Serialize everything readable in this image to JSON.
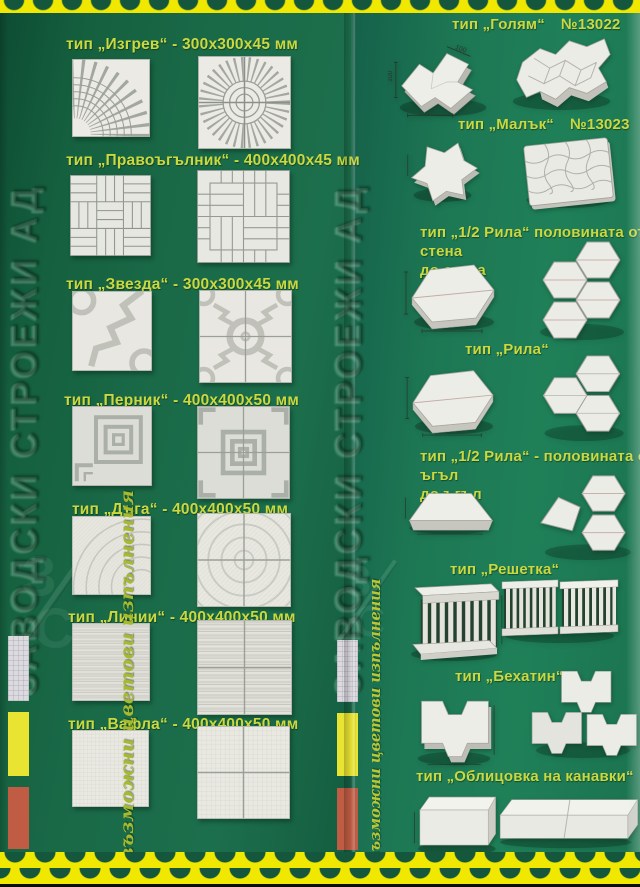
{
  "brand": {
    "vertical_text": "ЗАВОДСКИ СТРОЕЖИ АД",
    "monogram_top": "З",
    "monogram_bottom": "С"
  },
  "swatches": {
    "caption": "възможни цветови изпълнения",
    "colors": [
      {
        "name": "white",
        "hex": "#dcd9df"
      },
      {
        "name": "yellow",
        "hex": "#e9e431"
      },
      {
        "name": "red",
        "hex": "#c05c44"
      }
    ]
  },
  "palette": {
    "background_green_left": "#1a6a48",
    "background_green_right": "#1f8058",
    "border_yellow": "#f0e800",
    "scallop_green": "#14573c",
    "label_text": "#cbd83f",
    "tile_white": "#e9e9e3",
    "pattern_gray": "#9aa098"
  },
  "left_panel": {
    "items": [
      {
        "label": "тип „Изгрев“ - 300х300х45 мм"
      },
      {
        "label": "тип „Правоъгълник“ - 400х400х45 мм"
      },
      {
        "label": "тип „Звезда“ - 300х300х45 мм"
      },
      {
        "label": "тип „Перник“ - 400х400х50 мм"
      },
      {
        "label": "тип „Дъга“ - 400х400х50 мм"
      },
      {
        "label": "тип „Линии“ - 400х400х50 мм"
      },
      {
        "label": "тип „Вафла“ - 400х400х50 мм"
      }
    ]
  },
  "right_panel": {
    "items": [
      {
        "label": "тип „Голям“",
        "number": "№13022",
        "dims": [
          "100",
          "100"
        ]
      },
      {
        "label": "тип „Малък“",
        "number": "№13023"
      },
      {
        "label": "тип „1/2 Рила“ половината от стена\nдо стена"
      },
      {
        "label": "тип „Рила“"
      },
      {
        "label": "тип „1/2 Рила“ - половината от ъгъл\nдо ъгъл"
      },
      {
        "label": "тип „Решетка“"
      },
      {
        "label": "тип „Бехатин“"
      },
      {
        "label": "тип „Облицовка на канавки“"
      }
    ]
  }
}
